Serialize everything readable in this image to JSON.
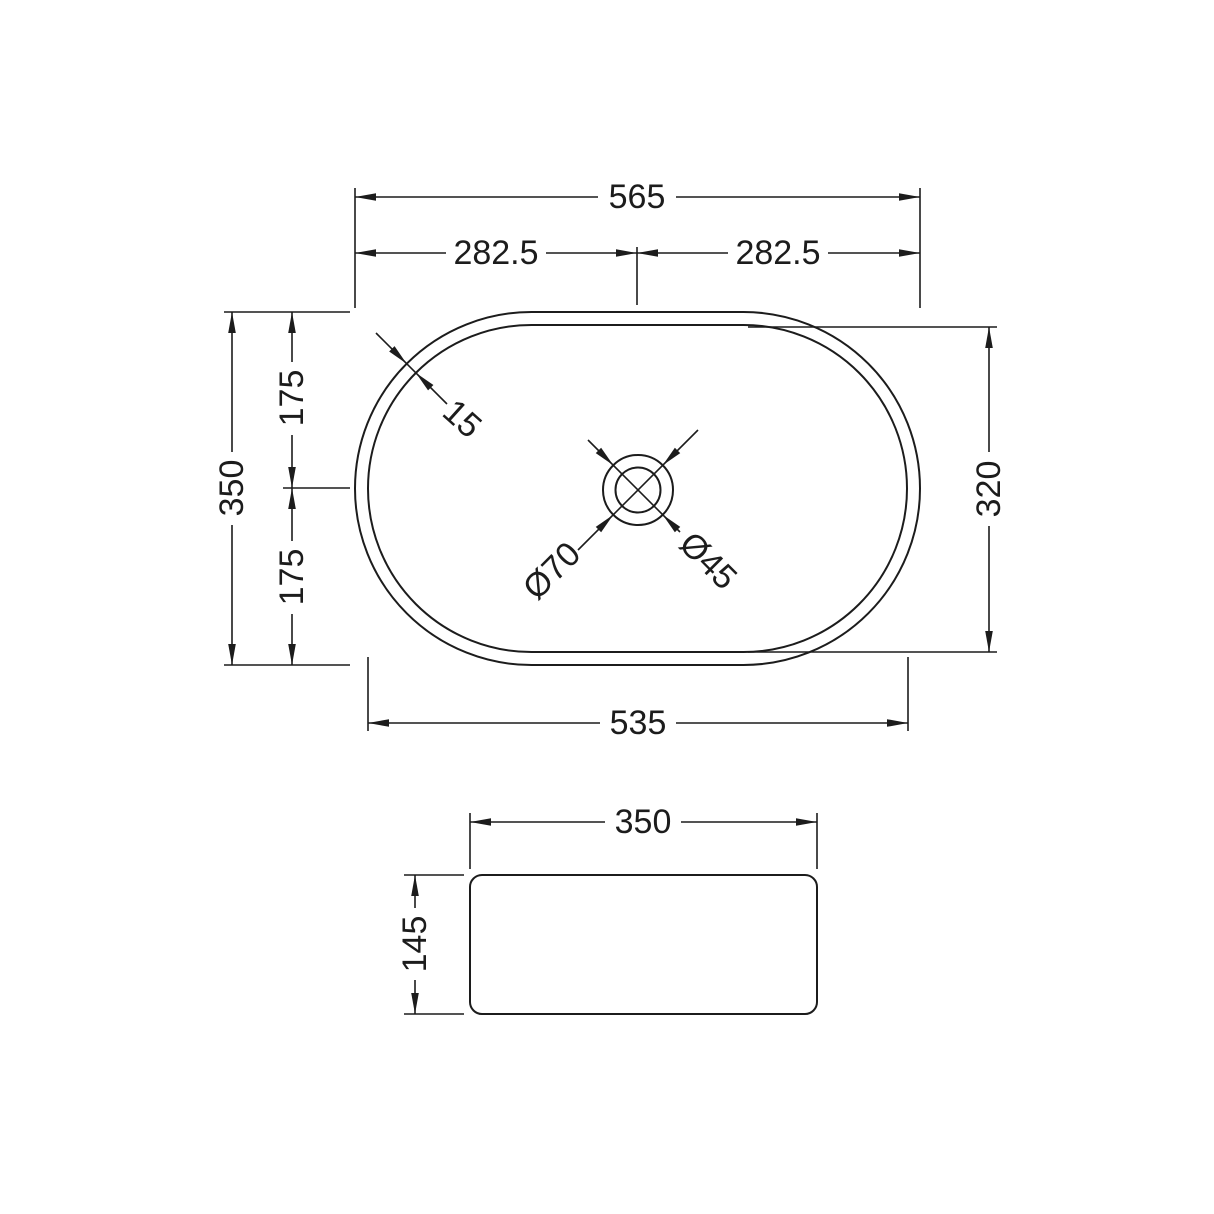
{
  "drawing": {
    "line_color": "#1c1c1c",
    "background_color": "#ffffff",
    "top_view": {
      "overall_width": "565",
      "half_width_left": "282.5",
      "half_width_right": "282.5",
      "overall_depth": "350",
      "half_depth_upper": "175",
      "half_depth_lower": "175",
      "inner_length": "535",
      "inner_depth": "320",
      "rim_thickness": "15",
      "waste_outer_diameter": "Ø70",
      "waste_hole_diameter": "Ø45"
    },
    "side_view": {
      "width": "350",
      "height": "145"
    }
  }
}
